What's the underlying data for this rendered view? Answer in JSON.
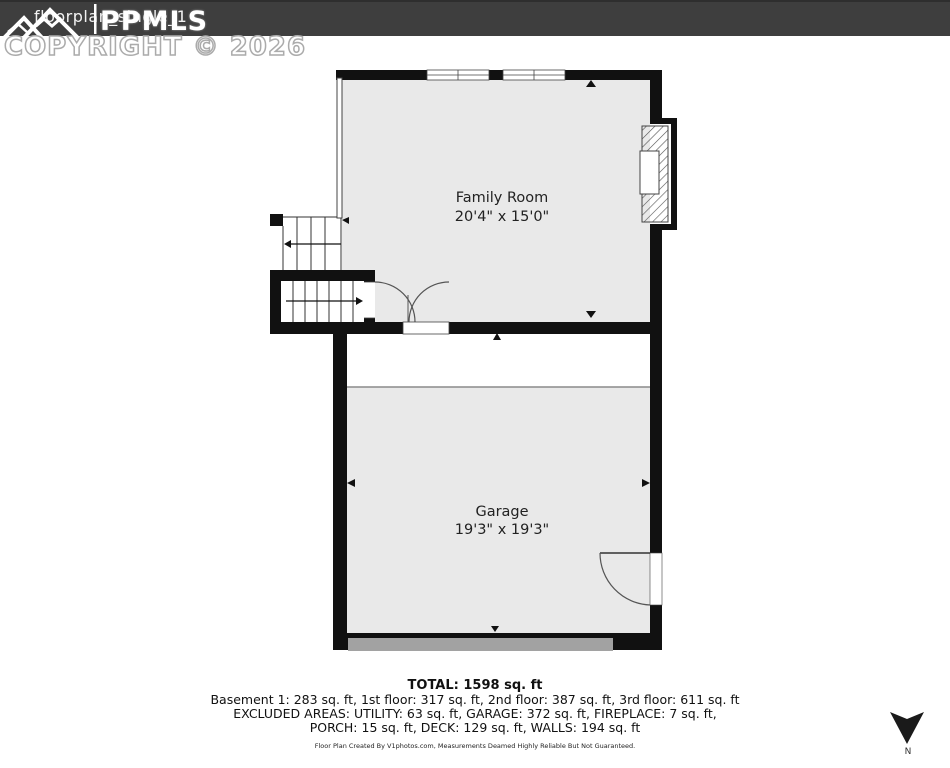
{
  "header": {
    "filename": "floorplan_single_1",
    "logo_text": "PPMLS",
    "copyright": "COPYRIGHT © 2026"
  },
  "rooms": [
    {
      "name": "Family Room",
      "dimensions": "20'4\" x 15'0\""
    },
    {
      "name": "Garage",
      "dimensions": "19'3\" x 19'3\""
    }
  ],
  "summary": {
    "total": "TOTAL: 1598 sq. ft",
    "floors": "Basement 1: 283 sq. ft, 1st floor: 317 sq. ft, 2nd floor: 387 sq. ft, 3rd floor: 611 sq. ft",
    "excluded_line1": "EXCLUDED AREAS: UTILITY: 63 sq. ft, GARAGE: 372 sq. ft, FIREPLACE: 7 sq. ft,",
    "excluded_line2": "PORCH: 15 sq. ft, DECK: 129 sq. ft, WALLS: 194 sq. ft",
    "disclaimer": "Floor Plan Created By V1photos.com, Measurements Deamed Highly Reliable But Not Guaranteed."
  },
  "compass": {
    "label": "N"
  },
  "colors": {
    "top_bar": "#3e3e3e",
    "wall": "#111111",
    "room_fill": "#e9e9e9",
    "garage_door_fill": "#a2a2a2"
  }
}
